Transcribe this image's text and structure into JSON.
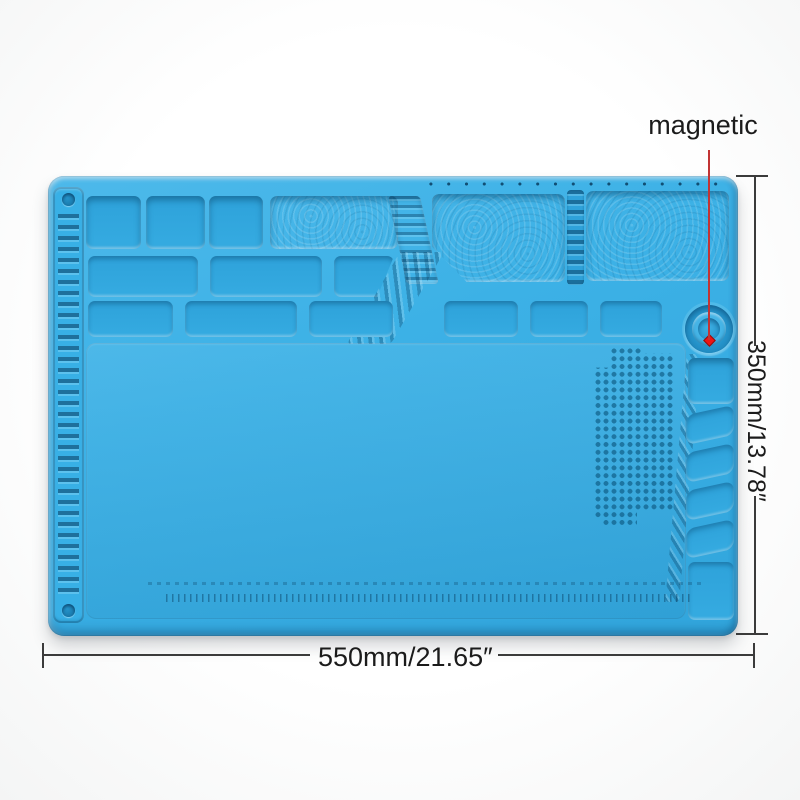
{
  "annotations": {
    "magnetic_label": "magnetic",
    "width_dimension": "550mm/21.65″",
    "height_dimension": "350mm/13.78″"
  },
  "colors": {
    "mat_blue": "#38b0e6",
    "mat_recess": "#2da0d8",
    "mat_dark_line": "#1579ac",
    "pointer_red": "#c23434",
    "dot_red": "#ee1414",
    "dimension_line": "#3b3b3b",
    "label_text": "#1b1b1b",
    "background": "#ffffff"
  }
}
